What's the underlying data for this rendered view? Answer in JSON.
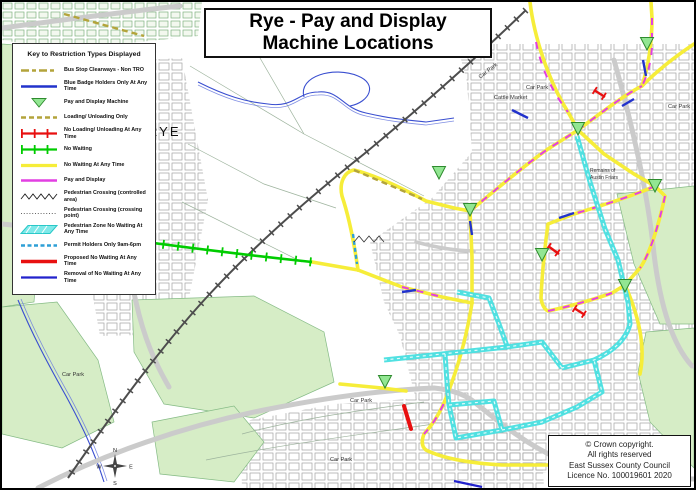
{
  "title": {
    "line1": "Rye - Pay and Display",
    "line2": "Machine Locations"
  },
  "legend": {
    "title": "Key to Restriction Types Displayed",
    "items": [
      {
        "label": "Bus Stop Clearways - Non TRO",
        "swatch": "bus-stop-clearway",
        "color": "#B3A43B"
      },
      {
        "label": "Blue Badge Holders Only At Any Time",
        "swatch": "blue-badge",
        "color": "#2233CC"
      },
      {
        "label": "Pay and Display Machine",
        "swatch": "pay-display-machine",
        "color": "#92E692"
      },
      {
        "label": "Loading/ Unloading Only",
        "swatch": "loading-unloading-only",
        "color": "#B3A43B"
      },
      {
        "label": "No Loading/ Unloading At Any Time",
        "swatch": "no-loading-unloading",
        "color": "#E81010"
      },
      {
        "label": "No Waiting",
        "swatch": "no-waiting",
        "color": "#00CC00"
      },
      {
        "label": "No Waiting At Any Time",
        "swatch": "no-waiting-any-time",
        "color": "#F6ED39"
      },
      {
        "label": "Pay and Display",
        "swatch": "pay-and-display",
        "color": "#E23FE2"
      },
      {
        "label": "Pedestrian Crossing (controlled area)",
        "swatch": "pedestrian-crossing-controlled",
        "color": "#333333"
      },
      {
        "label": "Pedestrian Crossing (crossing point)",
        "swatch": "pedestrian-crossing-point",
        "color": "#666666"
      },
      {
        "label": "Pedestrian Zone No Waiting At Any Time",
        "swatch": "pedestrian-zone",
        "color": "#48DFE0"
      },
      {
        "label": "Permit Holders Only 9am-6pm",
        "swatch": "permit-holders",
        "color": "#2E9FD6"
      },
      {
        "label": "Proposed No Waiting At Any Time",
        "swatch": "proposed-no-waiting",
        "color": "#E81010"
      },
      {
        "label": "Removal of No Waiting At Any Time",
        "swatch": "removal-no-waiting",
        "color": "#2222CC"
      }
    ]
  },
  "map_labels": {
    "rye": "RYE",
    "car_park": "Car Park",
    "cattle_market": "Cattle Market",
    "remains_line1": "Remains of",
    "remains_line2": "Austin Friars"
  },
  "compass": {
    "n": "N",
    "e": "E",
    "s": "S",
    "w": "W"
  },
  "copyright": {
    "line1": "© Crown copyright.",
    "line2": "All rights reserved",
    "line3": "East Sussex County Council",
    "line4": "Licence No. 100019601 2020"
  },
  "colors": {
    "no_waiting_any_time": "#F6ED39",
    "no_waiting": "#00CC00",
    "pedestrian_zone": "#48DFE0",
    "pay_and_display": "#E23FE2",
    "no_loading": "#E81010",
    "blue_badge": "#2233CC",
    "loading_olive": "#B3A43B",
    "machine_green": "#92E692",
    "vegetation": "#d6edc6"
  }
}
